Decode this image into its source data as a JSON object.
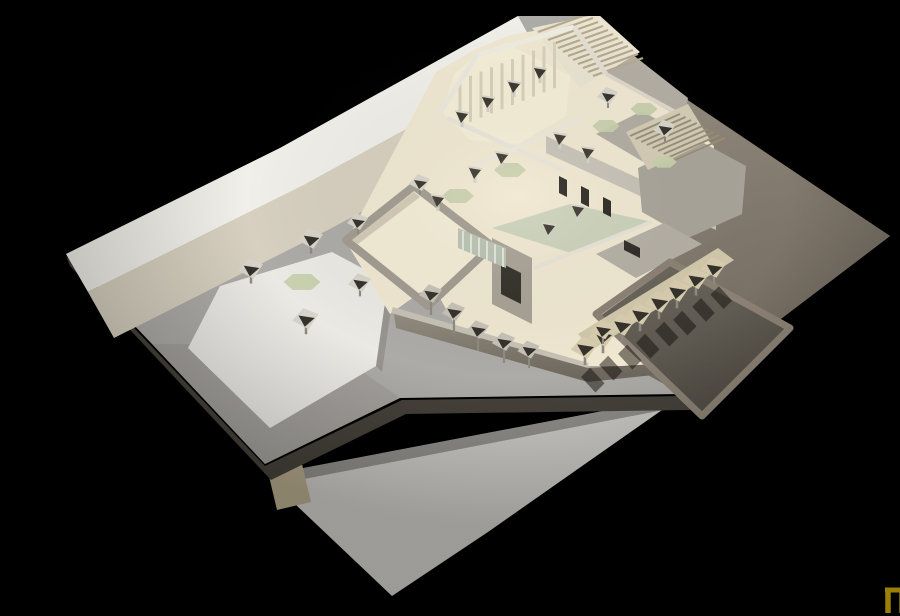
{
  "meta": {
    "title": "Architectural model photograph",
    "description": "Photograph of a cardboard architectural scale model of a flat-roofed building complex with open courtyards, parasols, stairs and a sunken terrace, shot against a black background",
    "background_color": "#000000"
  },
  "logo": {
    "name": "nu-monogram",
    "x": 845,
    "y": 574,
    "pi_color": "#9c7e0a",
    "u_color": "#c7a30f"
  },
  "palette": {
    "board": "#adaba7",
    "sidewalk": "#f1efe9",
    "road": "#d7d0c0",
    "plaza": "#ebe9e4",
    "cream_floor": "#f0e8d1",
    "gray_wall": "#a8a296",
    "pool_green": "#cbd2bb",
    "lawn_green": "#c7d0ad",
    "notch_dark": "#35322b",
    "parasol_variants": {
      "gray": {
        "canopy": "#d7d4cb"
      },
      "tan": {
        "canopy": "#d8cdaf"
      },
      "shade": {
        "canopy": "#c6c2b8"
      }
    },
    "post": "#8f8b81",
    "column_post": "#d3d0c7",
    "column_cap": "#3b372f",
    "column_rim": "#d8d5cc",
    "shadow": "rgba(18,16,12,0.5)"
  },
  "scene": {
    "elements": [
      {
        "kind": "poly",
        "name": "underlay-sheet",
        "pts": "232,458 642,380 448,516 352,580 236,470",
        "fill": "#c9c7c3"
      },
      {
        "kind": "poly",
        "name": "underlay-sheet-shade",
        "pts": "232,458 642,380 634,392 238,468",
        "fill": "#8e8c88"
      },
      {
        "kind": "poly",
        "name": "tan-scrap",
        "pts": "228,456 262,448 271,486 237,494",
        "fill": "#b2a689"
      },
      {
        "kind": "poly",
        "name": "board-edge-face",
        "pts": "26,240 225,450 362,384 644,380 650,394 366,398 231,464 30,250",
        "fill": "#45413a"
      },
      {
        "kind": "poly",
        "name": "main-board",
        "pts": "26,238 240,132 478,0 548,0 650,88 850,220 642,378 360,382 225,448 112,328",
        "fill": "#adaba7"
      },
      {
        "kind": "poly",
        "name": "east-yard",
        "pts": "612,60 850,220 642,378 548,326 596,190 600,120",
        "fill": "url(#gradEast)"
      },
      {
        "kind": "poly",
        "name": "ne-terrace-ground",
        "pts": "496,60 556,10 648,82 636,148 552,124",
        "fill": "#b3aea4"
      },
      {
        "kind": "poly",
        "name": "sidewalk-band",
        "pts": "26,238 240,132 478,0 500,40 262,170 48,276",
        "fill": "#f1efe9"
      },
      {
        "kind": "poly",
        "name": "road-band",
        "pts": "48,276 262,170 500,40 526,86 288,214 74,322",
        "fill": "#d7d0c0"
      },
      {
        "kind": "poly",
        "name": "southwest-shade",
        "pts": "112,328 225,448 360,382 320,354 228,408 150,328",
        "fill": "#9b9893",
        "op": 0.55
      },
      {
        "kind": "poly",
        "name": "plaza-platform",
        "pts": "148,332 180,270 292,236 348,266 336,350 230,412",
        "fill": "#ebe9e4"
      },
      {
        "kind": "poly",
        "name": "plaza-edge-shade",
        "pts": "336,350 348,266 354,272 342,356",
        "fill": "#8d8a84",
        "op": 0.7
      },
      {
        "kind": "poly",
        "name": "building-floor",
        "pts": "306,226 396,56 436,33 470,19 534,8 562,25 568,60 648,106 674,130 664,210 622,234 658,272 612,350 540,350 420,318 392,268 350,298",
        "fill": "#f0e8d1"
      },
      {
        "kind": "poly",
        "name": "stair-top-base",
        "pts": "492,12 558,-2 600,36 540,72",
        "fill": "#eae4d1"
      },
      {
        "kind": "lines",
        "name": "stair-top-treads",
        "sx": 498,
        "sy": 16,
        "dx": 5.0,
        "dy": 4.0,
        "lx": 50,
        "ly": -18,
        "n": 12,
        "color": "#b5aa8f",
        "w": 2.2
      },
      {
        "kind": "poly",
        "name": "north-hall-floor",
        "pts": "402,96 414,58 438,38 466,27 530,60 526,100 478,128 430,124",
        "fill": "#f5eed8"
      },
      {
        "kind": "lines",
        "name": "north-hall-window-panels",
        "sx": 420,
        "sy": 64,
        "dx": 10.5,
        "dy": -4.2,
        "lx": 0,
        "ly": 46,
        "n": 10,
        "color": "#d8d0ba",
        "w": 3
      },
      {
        "kind": "line",
        "name": "north-wall-west",
        "x1": 399,
        "y1": 98,
        "x2": 437,
        "y2": 39,
        "w": 5,
        "color": "#eceadf"
      },
      {
        "kind": "line",
        "name": "north-wall-top",
        "x1": 437,
        "y1": 39,
        "x2": 534,
        "y2": 11,
        "w": 5,
        "color": "#efece2"
      },
      {
        "kind": "line",
        "name": "north-wall-east",
        "x1": 534,
        "y1": 11,
        "x2": 566,
        "y2": 58,
        "w": 5,
        "color": "#e2ded2"
      },
      {
        "kind": "line",
        "name": "northeast-edge-wall",
        "x1": 566,
        "y1": 58,
        "x2": 650,
        "y2": 104,
        "w": 4,
        "color": "#ddd8cb"
      },
      {
        "kind": "line",
        "name": "north-hall-south-wall",
        "x1": 407,
        "y1": 102,
        "x2": 523,
        "y2": 154,
        "w": 4.5,
        "color": "#e9e5da"
      },
      {
        "kind": "poly",
        "name": "courtyard-pool",
        "pts": "452,212 530,188 608,205 534,238",
        "fill": "#cbd2bb"
      },
      {
        "kind": "line",
        "name": "courtyard-north-wall",
        "x1": 430,
        "y1": 152,
        "x2": 540,
        "y2": 104,
        "w": 4,
        "color": "#ece8dd"
      },
      {
        "kind": "line",
        "name": "courtyard-south-wall",
        "x1": 494,
        "y1": 252,
        "x2": 612,
        "y2": 206,
        "w": 4,
        "color": "#e7e3d7"
      },
      {
        "kind": "poly",
        "name": "west-room-wall-band",
        "pts": "306,224 374,170 452,230 388,290",
        "fill": "none",
        "stroke": "#a19b90",
        "sw": 8
      },
      {
        "kind": "poly",
        "name": "west-room-floor",
        "pts": "312,224 374,176 446,230 388,282",
        "fill": "#f3ecd6"
      },
      {
        "kind": "poly",
        "name": "west-room-inner-shadow",
        "pts": "312,224 374,176 380,181 318,228",
        "fill": "#c9c1ac",
        "op": 0.8
      },
      {
        "kind": "poly",
        "name": "east-roof-north",
        "pts": "556,118 602,95 670,134 624,158",
        "fill": "#b2ada2"
      },
      {
        "kind": "poly",
        "name": "east-wing-face",
        "pts": "506,120 600,163 676,197 676,214 600,180 506,137",
        "fill": "#c6c2b7"
      },
      {
        "kind": "poly",
        "name": "east-wing-roof",
        "pts": "598,152 658,124 706,150 702,198 648,222 602,196",
        "fill": "#a9a499"
      },
      {
        "kind": "poly",
        "name": "east-window-slot-1",
        "pts": "519,160 527,164 527,181 519,177",
        "fill": "#2a2722"
      },
      {
        "kind": "poly",
        "name": "east-window-slot-2",
        "pts": "541,170 549,174 549,191 541,187",
        "fill": "#2a2722"
      },
      {
        "kind": "poly",
        "name": "east-window-slot-3",
        "pts": "563,181 571,185 571,201 563,197",
        "fill": "#2a2722"
      },
      {
        "kind": "poly",
        "name": "southeast-room-roof",
        "pts": "556,238 624,207 662,228 596,262",
        "fill": "#b5b0a5"
      },
      {
        "kind": "poly",
        "name": "southeast-room-slot",
        "pts": "584,224 600,232 600,242 584,234",
        "fill": "#2e2b26"
      },
      {
        "kind": "poly",
        "name": "door-wall",
        "pts": "452,222 492,242 492,308 452,288",
        "fill": "#a8a296"
      },
      {
        "kind": "poly",
        "name": "door-opening",
        "pts": "461,247 481,257 481,288 461,278",
        "fill": "#332f29"
      },
      {
        "kind": "poly",
        "name": "glass-band",
        "pts": "418,212 466,232 466,252 418,232",
        "fill": "#b9c3b2"
      },
      {
        "kind": "lines",
        "name": "glass-mullions",
        "sx": 423,
        "sy": 215,
        "dx": 8,
        "dy": 3.4,
        "lx": 0,
        "ly": 19,
        "n": 6,
        "color": "#f4f2ea",
        "w": 1.4
      },
      {
        "kind": "line",
        "name": "south-facade-top",
        "x1": 352,
        "y1": 294,
        "x2": 548,
        "y2": 350,
        "w": 6,
        "color": "#c7c2b6"
      },
      {
        "kind": "poly",
        "name": "south-facade-face",
        "pts": "354,298 548,352 614,348 640,344 642,356 548,366 356,312",
        "fill": "url(#gradFace)"
      },
      {
        "kind": "poly",
        "name": "stair-ne-base",
        "pts": "586,116 648,88 670,124 608,154",
        "fill": "#d5ccb6"
      },
      {
        "kind": "lines",
        "name": "stair-ne-treads",
        "sx": 590,
        "sy": 120,
        "dx": 5.6,
        "dy": 3.0,
        "lx": 50,
        "ly": -22,
        "n": 9,
        "color": "#9a9078",
        "w": 2
      },
      {
        "kind": "poly",
        "name": "terrace-floor",
        "pts": "560,300 630,250 746,312 662,396",
        "fill": "url(#gradTerr)"
      },
      {
        "kind": "poly",
        "name": "terrace-wall-top",
        "pts": "556,298 630,246 750,312 662,400",
        "fill": "none",
        "stroke": "#8b8174",
        "sw": 7
      },
      {
        "kind": "poly",
        "name": "terrace-back-wall",
        "pts": "538,318 678,232 694,244 552,334",
        "fill": "#d2c8ab"
      },
      {
        "kind": "green",
        "name": "plaza-lawn-table",
        "x": 262,
        "y": 266,
        "s": 1.15
      },
      {
        "kind": "green",
        "name": "court-lawn-west",
        "x": 418,
        "y": 180,
        "s": 1.0
      },
      {
        "kind": "green",
        "name": "court-lawn-north",
        "x": 470,
        "y": 154,
        "s": 1.0
      },
      {
        "kind": "green",
        "name": "ne-lawn-1",
        "x": 566,
        "y": 110,
        "s": 0.85
      },
      {
        "kind": "green",
        "name": "ne-lawn-2",
        "x": 604,
        "y": 93,
        "s": 0.85
      },
      {
        "kind": "green",
        "name": "ne-lawn-3",
        "x": 624,
        "y": 146,
        "s": 0.8
      },
      {
        "kind": "column",
        "name": "column",
        "x": 422,
        "y": 102
      },
      {
        "kind": "column",
        "name": "column",
        "x": 448,
        "y": 87
      },
      {
        "kind": "column",
        "name": "column",
        "x": 474,
        "y": 72
      },
      {
        "kind": "column",
        "name": "column",
        "x": 500,
        "y": 58
      },
      {
        "kind": "column",
        "name": "column",
        "x": 435,
        "y": 158
      },
      {
        "kind": "column",
        "name": "column",
        "x": 462,
        "y": 143
      },
      {
        "kind": "column",
        "name": "column",
        "x": 398,
        "y": 186
      },
      {
        "kind": "column",
        "name": "column",
        "x": 520,
        "y": 124
      },
      {
        "kind": "column",
        "name": "column",
        "x": 548,
        "y": 138
      },
      {
        "kind": "column",
        "name": "column",
        "x": 509,
        "y": 214
      },
      {
        "kind": "column",
        "name": "column",
        "x": 538,
        "y": 196
      },
      {
        "kind": "parasol",
        "name": "plaza-parasol",
        "x": 211,
        "y": 252,
        "s": 1.2,
        "variant": "gray"
      },
      {
        "kind": "parasol",
        "name": "plaza-parasol",
        "x": 271,
        "y": 222,
        "s": 1.2,
        "variant": "gray"
      },
      {
        "kind": "parasol",
        "name": "plaza-parasol",
        "x": 266,
        "y": 302,
        "s": 1.25,
        "variant": "gray"
      },
      {
        "kind": "parasol",
        "name": "plaza-parasol",
        "x": 320,
        "y": 266,
        "s": 1.1,
        "variant": "gray"
      },
      {
        "kind": "parasol",
        "name": "plaza-parasol",
        "x": 318,
        "y": 205,
        "s": 1.0,
        "variant": "gray"
      },
      {
        "kind": "parasol",
        "name": "plaza-parasol",
        "x": 380,
        "y": 166,
        "s": 1.0,
        "variant": "gray"
      },
      {
        "kind": "parasol",
        "name": "ne-parasol",
        "x": 568,
        "y": 79,
        "s": 1.0,
        "variant": "gray"
      },
      {
        "kind": "parasol",
        "name": "ne-parasol",
        "x": 625,
        "y": 112,
        "s": 1.05,
        "variant": "gray"
      },
      {
        "kind": "parasol",
        "name": "colonnade-parasol",
        "x": 391,
        "y": 277,
        "s": 1.1,
        "variant": "shade",
        "post": 16
      },
      {
        "kind": "parasol",
        "name": "colonnade-parasol",
        "x": 414,
        "y": 295,
        "s": 1.1,
        "variant": "shade",
        "post": 16
      },
      {
        "kind": "parasol",
        "name": "colonnade-parasol",
        "x": 438,
        "y": 313,
        "s": 1.1,
        "variant": "shade",
        "post": 16
      },
      {
        "kind": "parasol",
        "name": "colonnade-parasol",
        "x": 464,
        "y": 325,
        "s": 1.1,
        "variant": "shade",
        "post": 16
      },
      {
        "kind": "parasol",
        "name": "colonnade-parasol",
        "x": 489,
        "y": 333,
        "s": 1.05,
        "variant": "shade",
        "post": 14
      },
      {
        "kind": "parasol",
        "name": "terrace-parasol",
        "x": 545,
        "y": 331,
        "s": 1.3,
        "variant": "tan",
        "post": 10,
        "shadow": true
      },
      {
        "kind": "parasol",
        "name": "terrace-parasol",
        "x": 563,
        "y": 319,
        "s": 1.3,
        "variant": "tan",
        "post": 10,
        "shadow": true
      },
      {
        "kind": "parasol",
        "name": "terrace-parasol",
        "x": 582,
        "y": 308,
        "s": 1.3,
        "variant": "tan",
        "post": 10,
        "shadow": true
      },
      {
        "kind": "parasol",
        "name": "terrace-parasol",
        "x": 600,
        "y": 297,
        "s": 1.3,
        "variant": "tan",
        "post": 10,
        "shadow": true
      },
      {
        "kind": "parasol",
        "name": "terrace-parasol",
        "x": 619,
        "y": 285,
        "s": 1.3,
        "variant": "tan",
        "post": 10,
        "shadow": true
      },
      {
        "kind": "parasol",
        "name": "terrace-parasol",
        "x": 637,
        "y": 274,
        "s": 1.3,
        "variant": "tan",
        "post": 10,
        "shadow": true
      },
      {
        "kind": "parasol",
        "name": "terrace-parasol",
        "x": 656,
        "y": 262,
        "s": 1.25,
        "variant": "tan",
        "post": 10,
        "shadow": true
      },
      {
        "kind": "parasol",
        "name": "terrace-parasol",
        "x": 674,
        "y": 251,
        "s": 1.2,
        "variant": "tan",
        "post": 10,
        "shadow": true
      },
      {
        "kind": "parasol",
        "name": "yard-parasol",
        "x": 563,
        "y": 313,
        "s": 1.15,
        "variant": "tan"
      },
      {
        "kind": "poly",
        "name": "photo-glow",
        "pts": "0,0 900,0 900,600 0,600",
        "fill": "url(#glow)"
      }
    ]
  }
}
